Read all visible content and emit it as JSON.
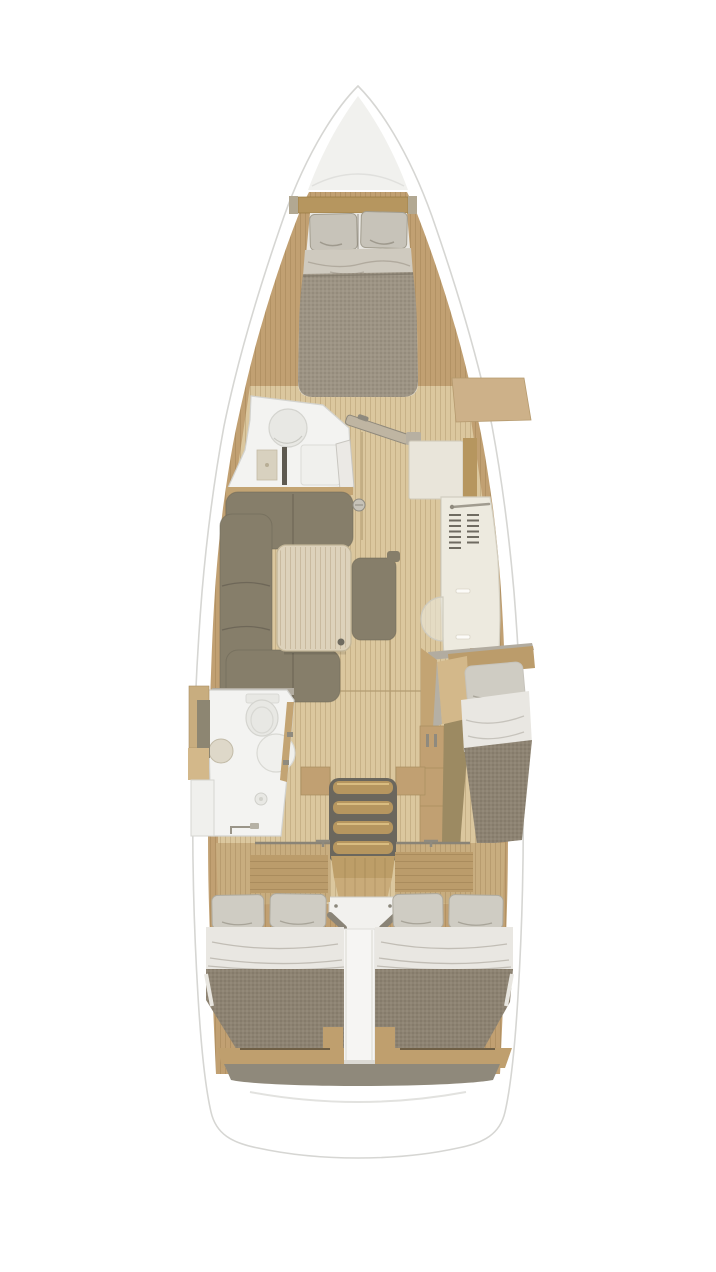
{
  "scene": {
    "subject": "sailing-yacht-interior-floorplan",
    "view": "top-down",
    "zones": [
      "bow-deck",
      "forward-cabin",
      "forward-head",
      "salon",
      "galley",
      "chart-table",
      "companionway-stairs",
      "mid-starboard-cabin",
      "aft-head",
      "aft-cabin-port",
      "aft-cabin-starboard",
      "stern-deck"
    ]
  },
  "colors": {
    "hull": "#ffffff",
    "hull_stroke": "#d6d6d3",
    "bow_shade": "#f1f1ee",
    "side_wood": "#c1a072",
    "floor": "#dbc79e",
    "floor_seam": "#b39d72",
    "trim_wood": "#b6965f",
    "wood_light": "#cdb189",
    "wood_block": "#c3a473",
    "wedge_wood": "#d3b88a",
    "strip_wood": "#c8ad7f",
    "slat_wood": "#bb9c6b",
    "stern_wood": "#bf9f6e",
    "landing_wood": "#bd9e68",
    "ramp_wood": "#c9ab79",
    "step_wood": "#b6965f",
    "step_shadow": "#6b675d",
    "pillow": "#cfccc3",
    "pillow_fwd": "#c7c3b9",
    "sheet": "#e9e7e2",
    "fold": "#cfcabf",
    "blanket": "#8d8372",
    "blanket_fwd": "#9d9484",
    "sofa": "#867e6a",
    "sofa_seam": "#6e6758",
    "table": "#ddd2bb",
    "table_edge": "#c3b698",
    "knob": "#c6c2b8",
    "bath_floor": "#f3f3f1",
    "bath_stroke": "#d3d3cf",
    "fixture": "#e8e8e4",
    "fixture_stroke": "#d4d4cf",
    "cabinet_beige": "#d8d1bf",
    "dark_slot": "#5e5a51",
    "door_panel": "#ebe9e5",
    "counter": "#edeadf",
    "counter_stroke": "#d2cec0",
    "chart_table": "#e9e5da",
    "vent": "#6f6b61",
    "rail_bar": "#bfb5a2",
    "hardware": "#8f8a7e",
    "gray_wall": "#b2aca0",
    "gray_door": "#b5b0a5",
    "dark_floor": "#9c8a62",
    "white_box": "#f2f1ee",
    "box_trim": "#8a8477",
    "white_col": "#f6f5f3",
    "dark_ledge": "#8f897b",
    "dark_edge": "#6f5f45",
    "shelf_white": "#f0f0ed",
    "divider_dark": "#8d8672"
  }
}
